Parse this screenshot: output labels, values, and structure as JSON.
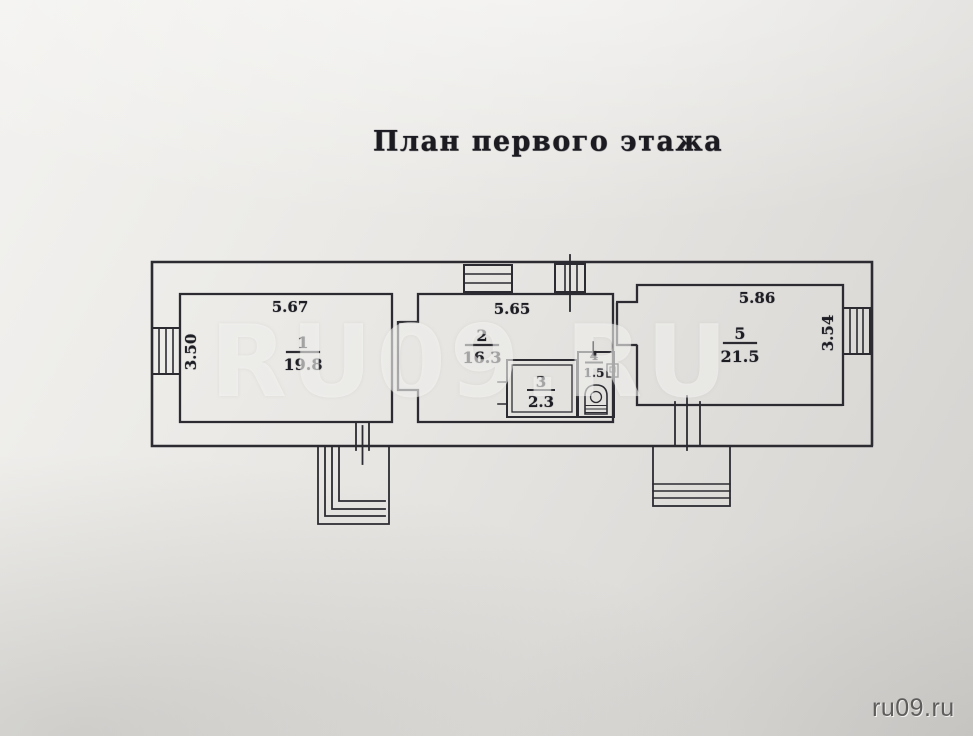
{
  "photo": {
    "title": "План первого этажа",
    "watermark": "RU09.RU",
    "credit": "ru09.ru"
  },
  "plan": {
    "rooms": [
      {
        "number": "1",
        "area": "19.8"
      },
      {
        "number": "2",
        "area": "16.3"
      },
      {
        "number": "3",
        "area": "2.3"
      },
      {
        "number": "4",
        "area": "1.5"
      },
      {
        "number": "5",
        "area": "21.5"
      }
    ],
    "dimensions": {
      "room1_width": "5.67",
      "room1_depth": "3.50",
      "room2_width": "5.65",
      "room5_width": "5.86",
      "room5_depth": "3.54"
    },
    "colors": {
      "ink": "#2b2b31",
      "paper": "#e8e6e3",
      "watermark_text": "rgba(252,252,250,0.5)",
      "credit_text": "#5f5d5c"
    }
  }
}
